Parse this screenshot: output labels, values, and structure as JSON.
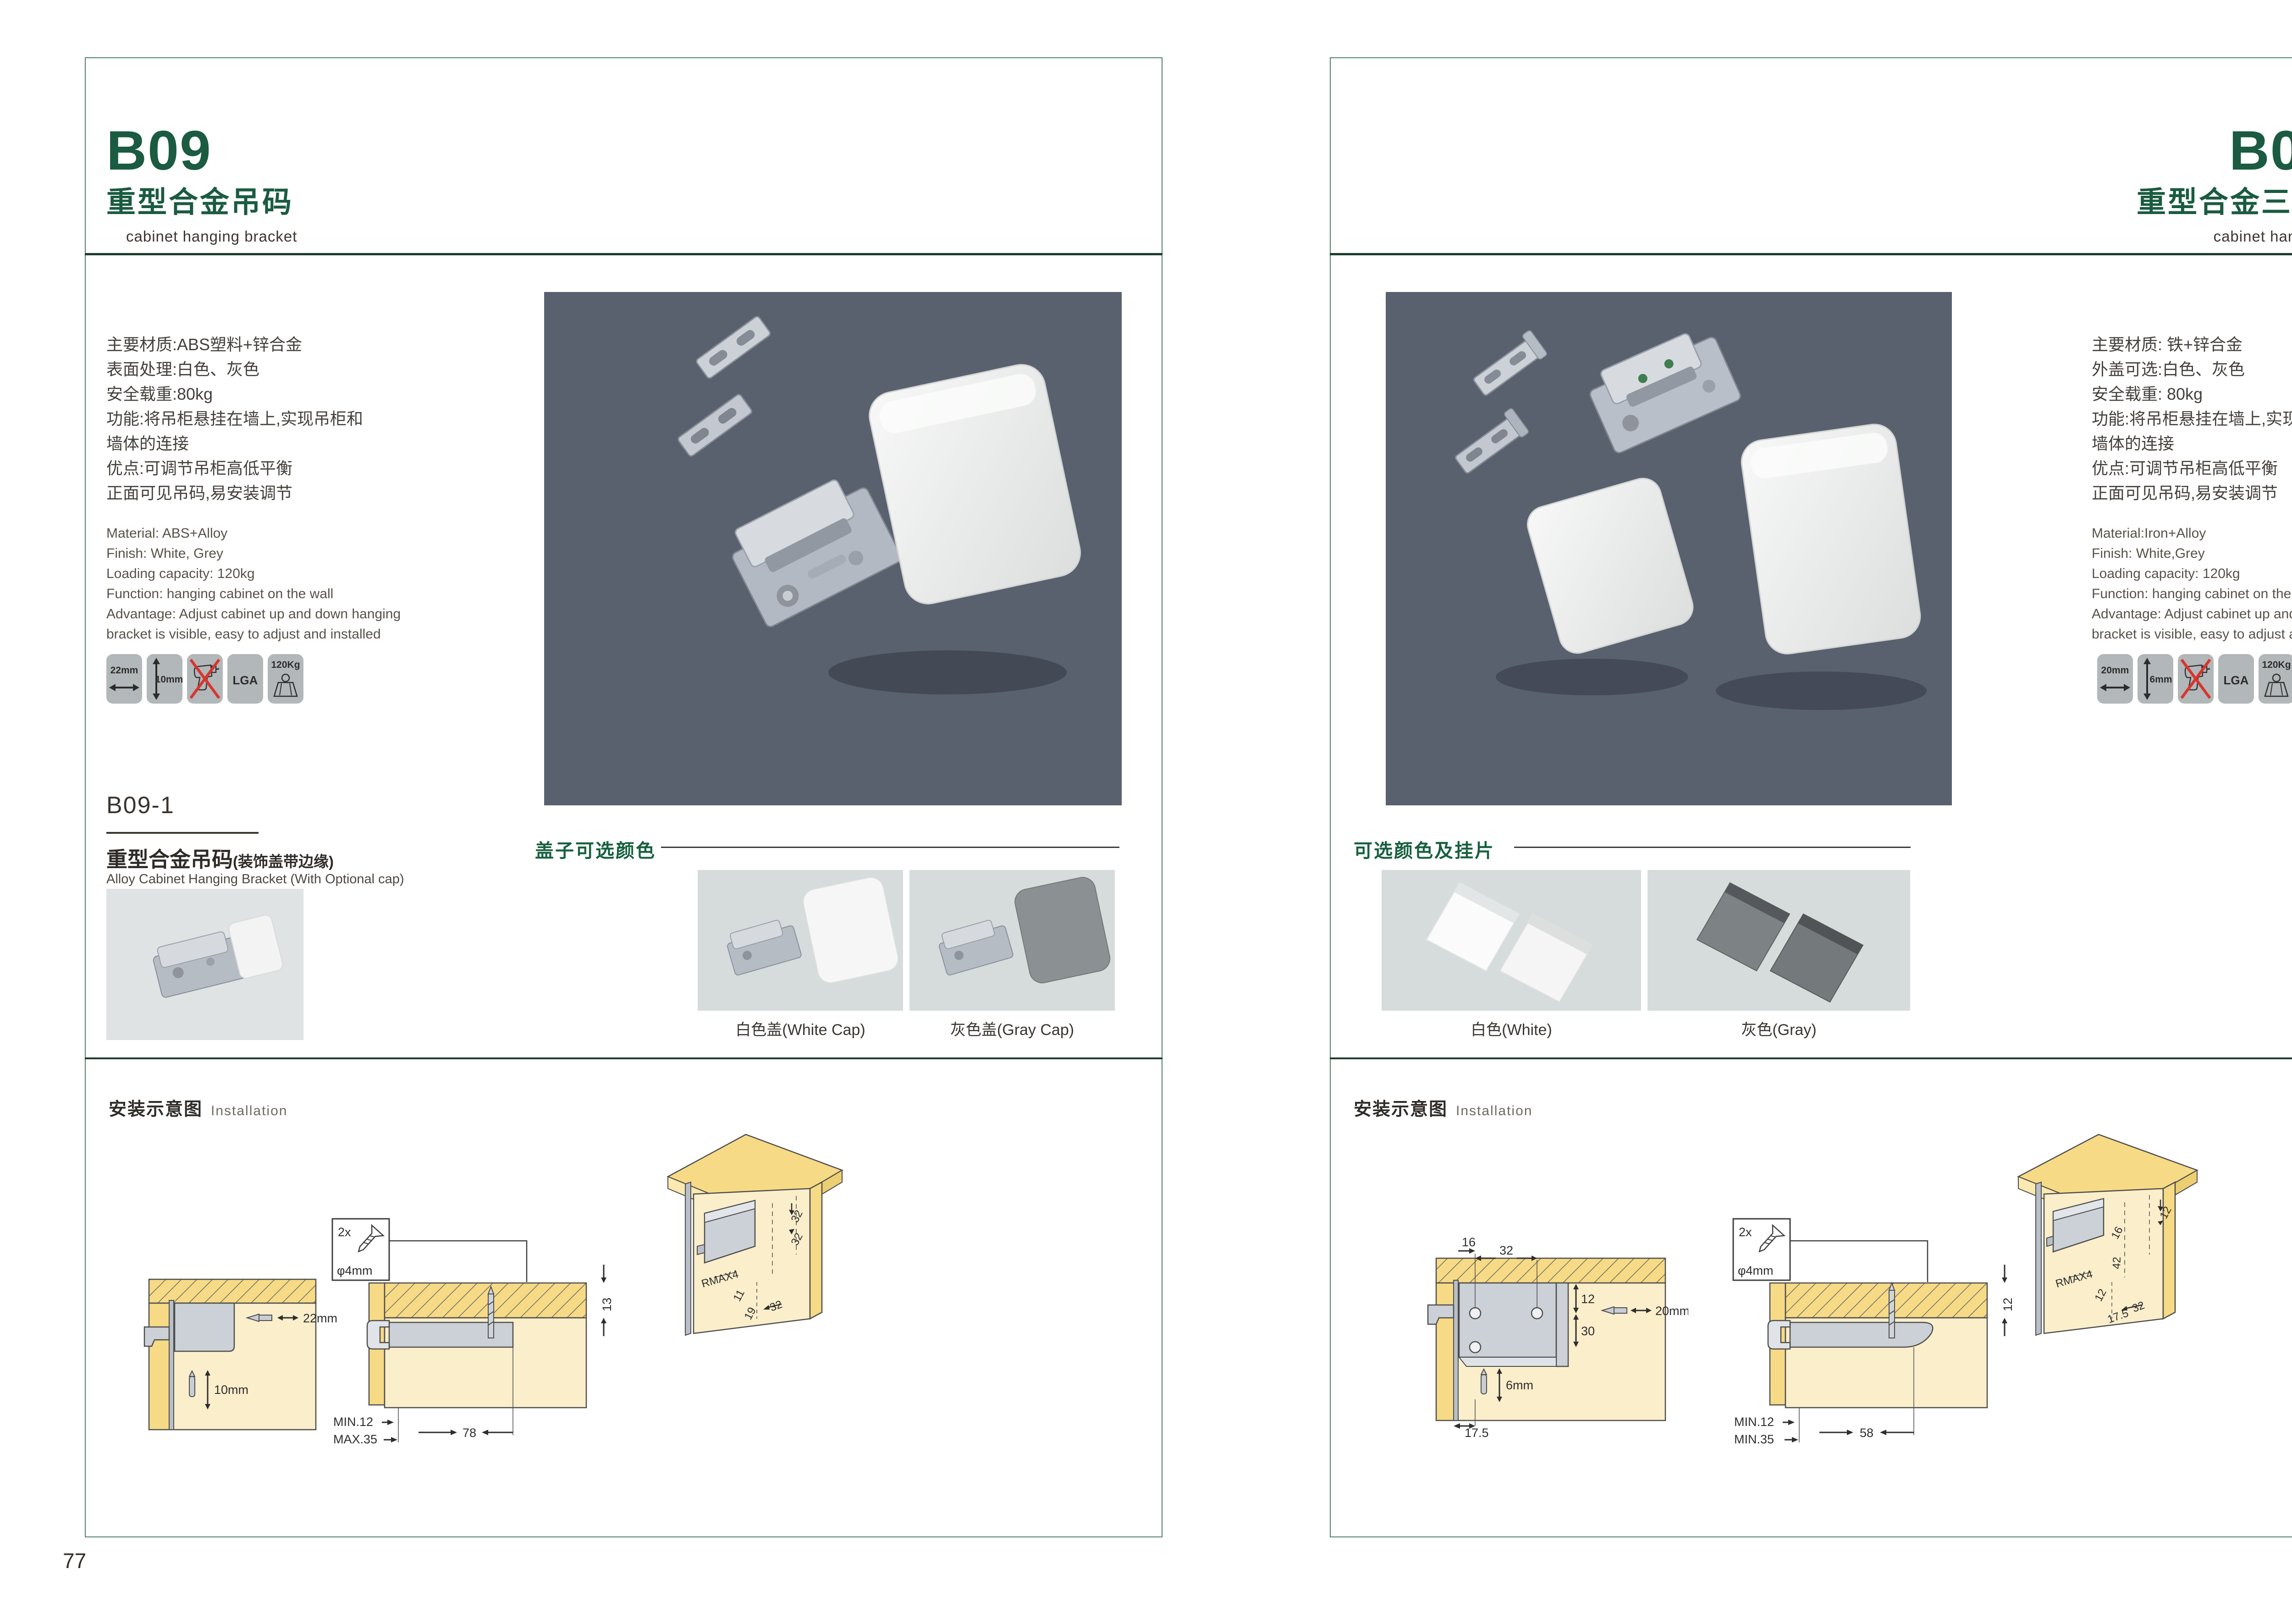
{
  "brand": {
    "green": "#1a5b41",
    "panel_border": "#53806a",
    "photo_bg": "#59616f"
  },
  "pages": {
    "left": {
      "page_number": "77",
      "header": {
        "code": "B09",
        "title_zh": "重型合金吊码",
        "title_en": "cabinet hanging bracket"
      },
      "specs_zh": [
        "主要材质:ABS塑料+锌合金",
        "表面处理:白色、灰色",
        "安全载重:80kg",
        "功能:将吊柜悬挂在墙上,实现吊柜和",
        "墙体的连接",
        "优点:可调节吊柜高低平衡",
        "正面可见吊码,易安装调节"
      ],
      "specs_en": [
        "Material: ABS+Alloy",
        "Finish: White, Grey",
        "Loading capacity: 120kg",
        "Function: hanging cabinet on the wall",
        "Advantage: Adjust cabinet up and down hanging",
        "bracket is visible, easy to adjust and installed"
      ],
      "icons": {
        "w": "22mm",
        "h": "10mm",
        "cert": "LGA",
        "load": "120Kg"
      },
      "sub": {
        "code": "B09-1",
        "title_zh": "重型合金吊码",
        "title_note": "(装饰盖带边缘)",
        "title_en": "Alloy Cabinet Hanging Bracket (With Optional cap)"
      },
      "caps": {
        "title": "盖子可选颜色",
        "white": "白色盖(White Cap)",
        "gray": "灰色盖(Gray Cap)"
      },
      "install": {
        "title_zh": "安装示意图",
        "title_en": "Installation",
        "front": {
          "w": "22mm",
          "h": "10mm"
        },
        "screw": {
          "count": "2x",
          "dia": "φ4mm"
        },
        "side": {
          "t": "13",
          "min": "MIN.12",
          "max": "MAX.35",
          "len": "78"
        },
        "persp": {
          "d1": "32",
          "d2": "32",
          "r": "RMAX4",
          "a": "11",
          "b": "19",
          "c": "32"
        }
      }
    },
    "right": {
      "page_number": "78",
      "header": {
        "code": "B09-3",
        "title_zh": "重型合金三孔吊码",
        "title_en": "cabinet hanging bracket"
      },
      "specs_zh": [
        "主要材质: 铁+锌合金",
        "外盖可选:白色、灰色",
        "安全载重: 80kg",
        "功能:将吊柜悬挂在墙上,实现吊柜和",
        "墙体的连接",
        "优点:可调节吊柜高低平衡",
        "正面可见吊码,易安装调节"
      ],
      "specs_en": [
        "Material:Iron+Alloy",
        "Finish: White,Grey",
        "Loading capacity: 120kg",
        "Function: hanging cabinet on the wall",
        "Advantage: Adjust cabinet up and down hanging",
        "bracket is visible, easy to adjust and installed"
      ],
      "icons": {
        "w": "20mm",
        "h": "6mm",
        "cert": "LGA",
        "load": "120Kg"
      },
      "caps": {
        "title": "可选颜色及挂片",
        "white": "白色(White)",
        "gray": "灰色(Gray)"
      },
      "install": {
        "title_zh": "安装示意图",
        "title_en": "Installation",
        "front": {
          "a": "16",
          "b": "32",
          "c": "12",
          "d": "30",
          "drill": "20mm",
          "bit": "6mm",
          "e": "17.5"
        },
        "screw": {
          "count": "2x",
          "dia": "φ4mm"
        },
        "side": {
          "t": "12",
          "min": "MIN.12",
          "max": "MIN.35",
          "len": "58"
        },
        "persp": {
          "top": "12",
          "a": "16",
          "b": "42",
          "r": "RMAX4",
          "c": "12",
          "d": "17.5",
          "e": "32"
        }
      }
    }
  }
}
